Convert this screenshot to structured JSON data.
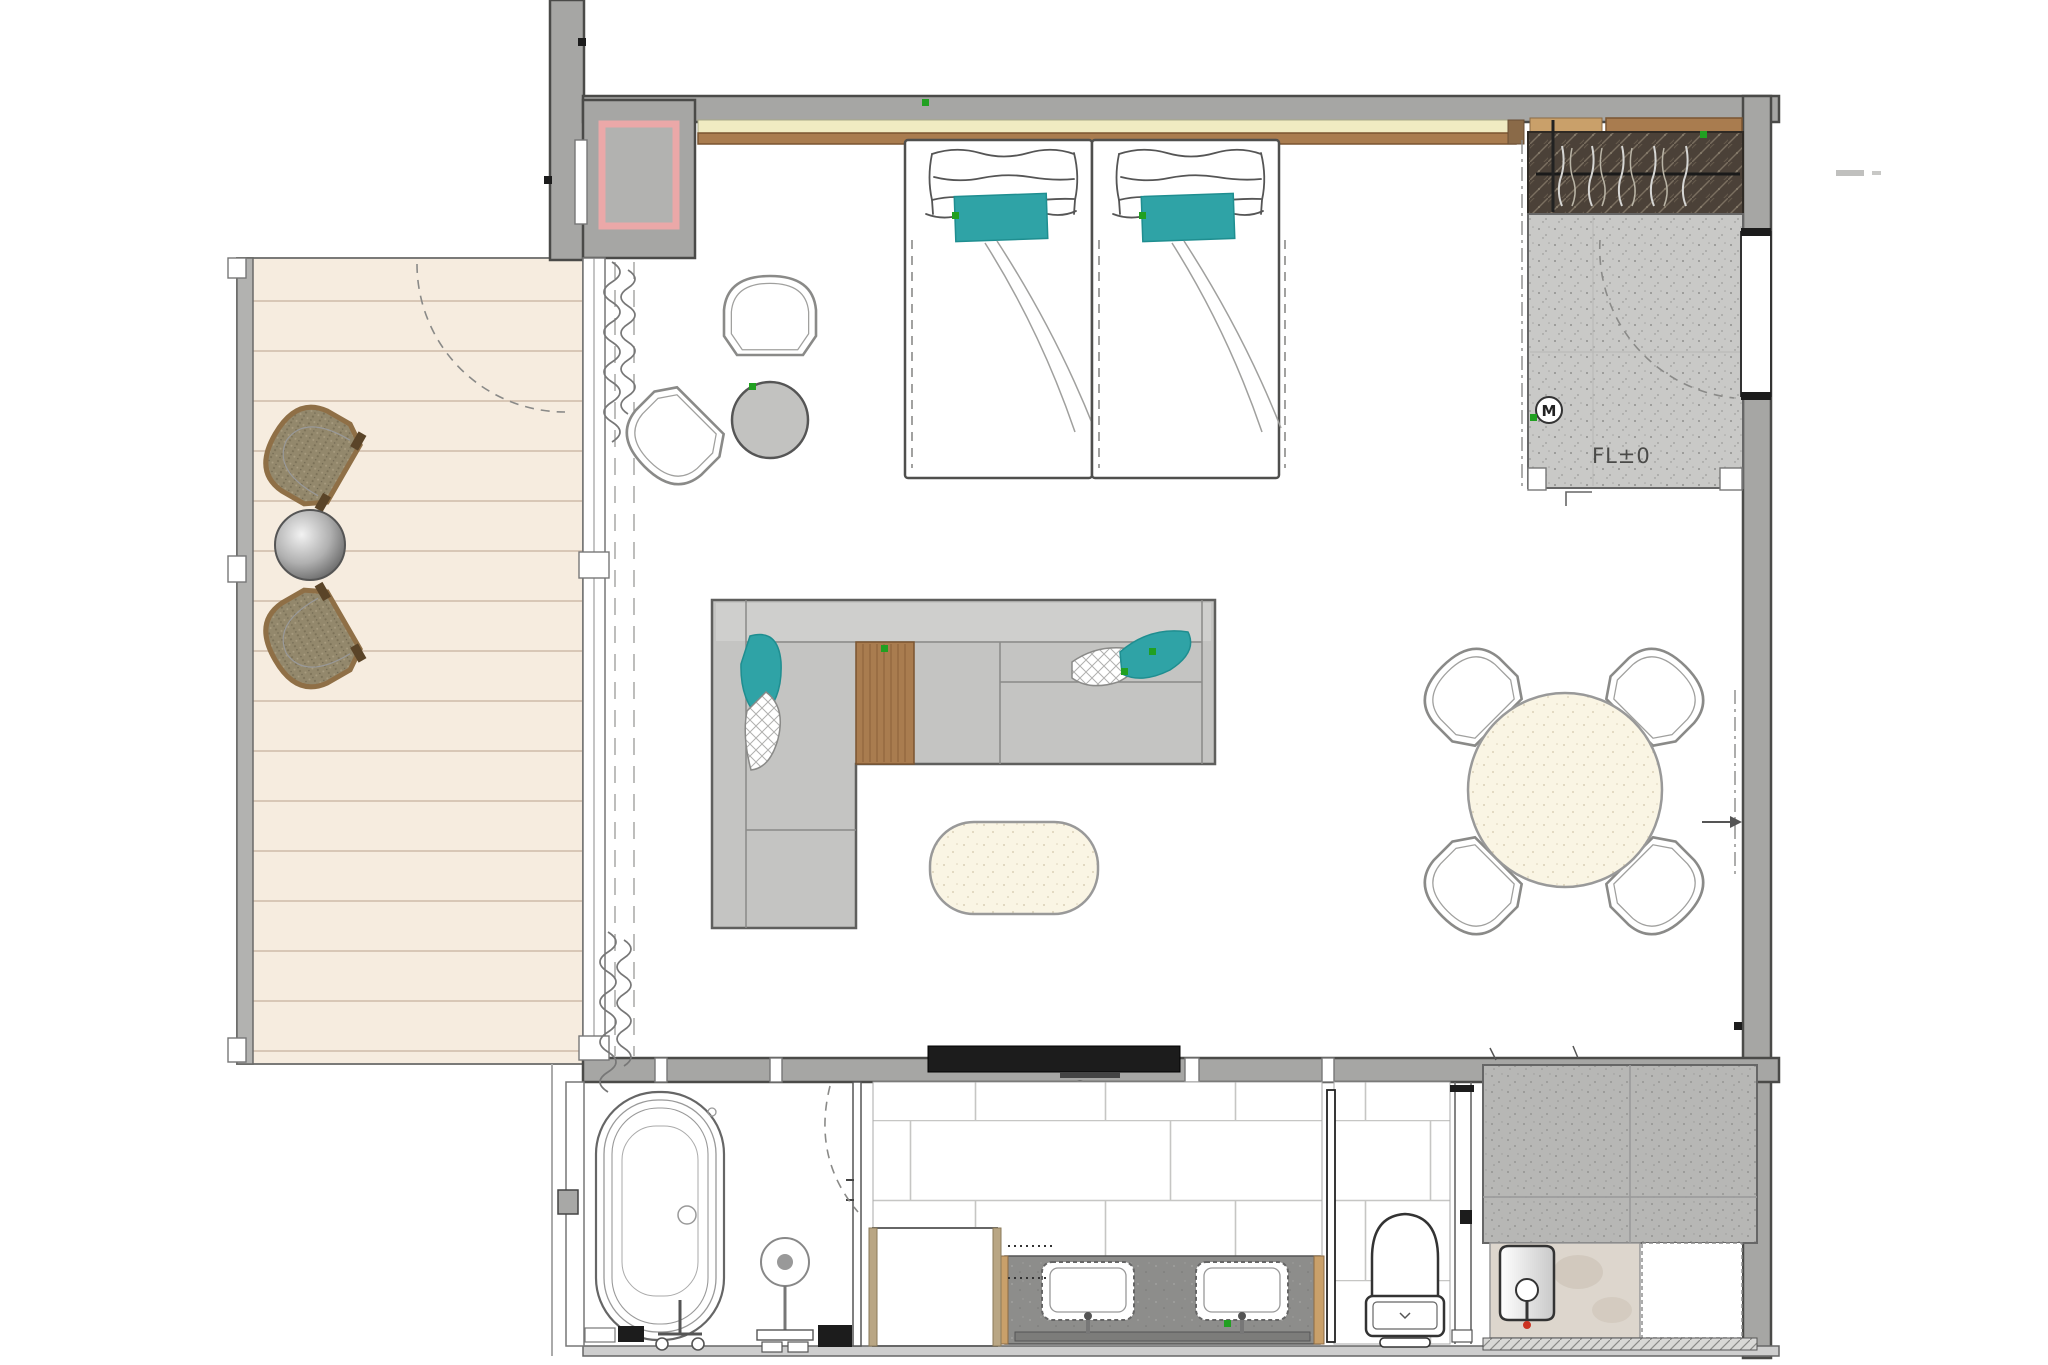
{
  "labels": {
    "floor_level": "FL±0",
    "door_symbol": "M"
  },
  "colors": {
    "wall": "#a6a6a4",
    "wall_line": "#4a4a48",
    "balcony_floor": "#f6ecdf",
    "deck_line": "#d8c7b6",
    "entry_floor": "#c9c9c7",
    "closet_dark": "#4b4138",
    "wood": "#a97c4f",
    "wood_light": "#c9a06a",
    "headboard_cream": "#f0ebc2",
    "teal": "#2fa3a6",
    "sofa_gray": "#c4c4c2",
    "sofa_light": "#cfcfcd",
    "cream": "#faf5e4",
    "counter_dark": "#8d8d8b",
    "storage_gray": "#b7b7b5",
    "wicker_tan": "#93886c",
    "marble": "#ddd6cd",
    "green_marker": "#21a021",
    "red_marker": "#cc3322",
    "pink_shaft": "#eba8a8"
  }
}
